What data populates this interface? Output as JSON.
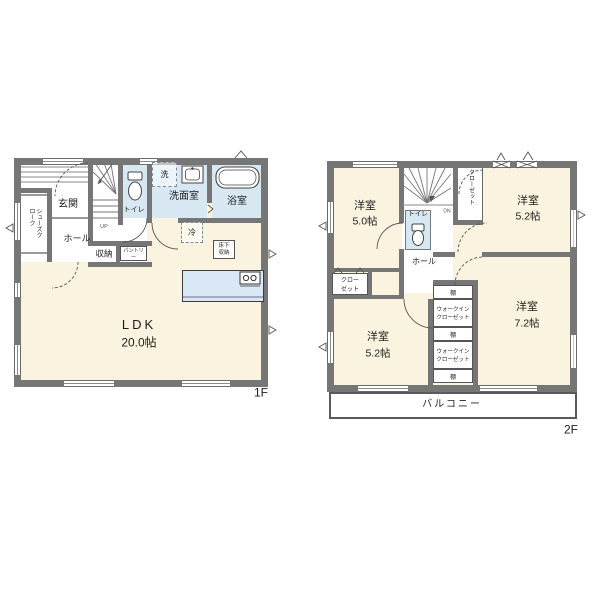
{
  "meta": {
    "type": "floor-plan",
    "colors": {
      "wall": "#767676",
      "floor_cream": "#faf3e0",
      "wet_area_blue": "#d7e8f3",
      "counter_blue": "#d9e8f4",
      "linework": "#555555",
      "background": "#ffffff"
    }
  },
  "f1": {
    "label": "1F",
    "ldk": "LDK",
    "ldk_size": "20.0帖",
    "genkan": "玄関",
    "shoes": "シューズクローク",
    "hall": "ホール",
    "up": "UP",
    "toilet": "トイレ",
    "washer": "洗",
    "washroom": "洗面室",
    "bath": "浴室",
    "storage": "収納",
    "pantry": "パントリー",
    "fridge": "冷",
    "underfloor": "床下収納"
  },
  "f2": {
    "label": "2F",
    "bedroom_nw": "洋室",
    "bedroom_nw_size": "5.0帖",
    "bedroom_ne": "洋室",
    "bedroom_ne_size": "5.2帖",
    "bedroom_sw": "洋室",
    "bedroom_sw_size": "5.2帖",
    "bedroom_se": "洋室",
    "bedroom_se_size": "7.2帖",
    "dn": "DN",
    "toilet": "トイレ",
    "closet_vert": "クローゼット",
    "closet_box": "クローゼット",
    "hall": "ホール",
    "shelf": "棚",
    "wic": "ウォークインクローゼット",
    "balcony": "バルコニー"
  }
}
